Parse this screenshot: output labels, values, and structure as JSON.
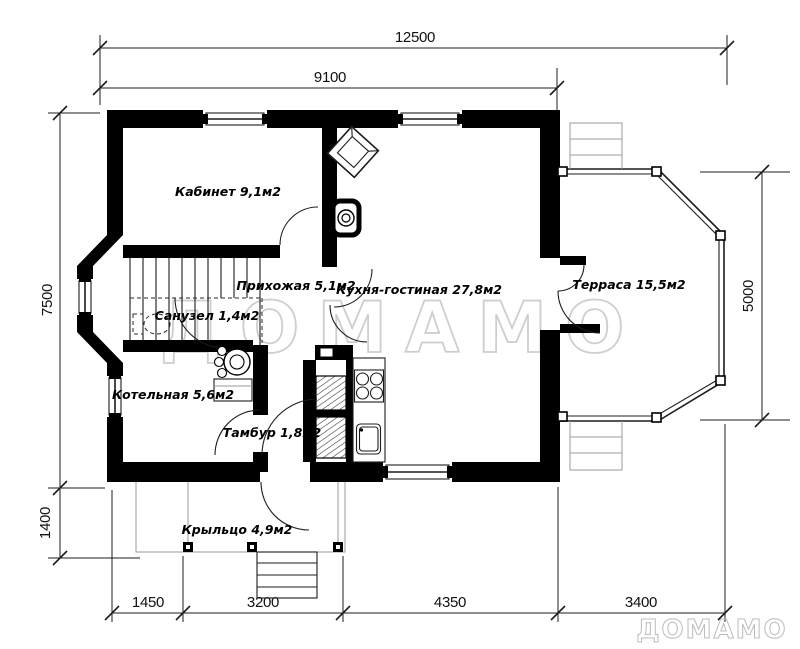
{
  "rooms": {
    "kabinet": "Кабинет  9,1м2",
    "prihozhaya": "Прихожая  5,1м2",
    "kuhnya": "Кухня-гостиная  27,8м2",
    "terrasa": "Терраса  15,5м2",
    "sanuzel": "Санузел  1,4м2",
    "kotelnaya": "Котельная  5,6м2",
    "tambur": "Тамбур  1,8м2",
    "krylco": "Крыльцо  4,9м2"
  },
  "dims": {
    "total_width": "12500",
    "house_width": "9100",
    "house_depth": "7500",
    "porch_depth": "1400",
    "terrace_depth": "5000",
    "bottom": [
      "1450",
      "3200",
      "4350",
      "3400"
    ]
  },
  "watermark": {
    "text": "ДОМАМО"
  },
  "brand": {
    "text": "ДОМАМО"
  },
  "colors": {
    "wall": "#000000",
    "line": "#1c1c1c",
    "watermark": "#c2c2c2",
    "background": "#ffffff"
  }
}
